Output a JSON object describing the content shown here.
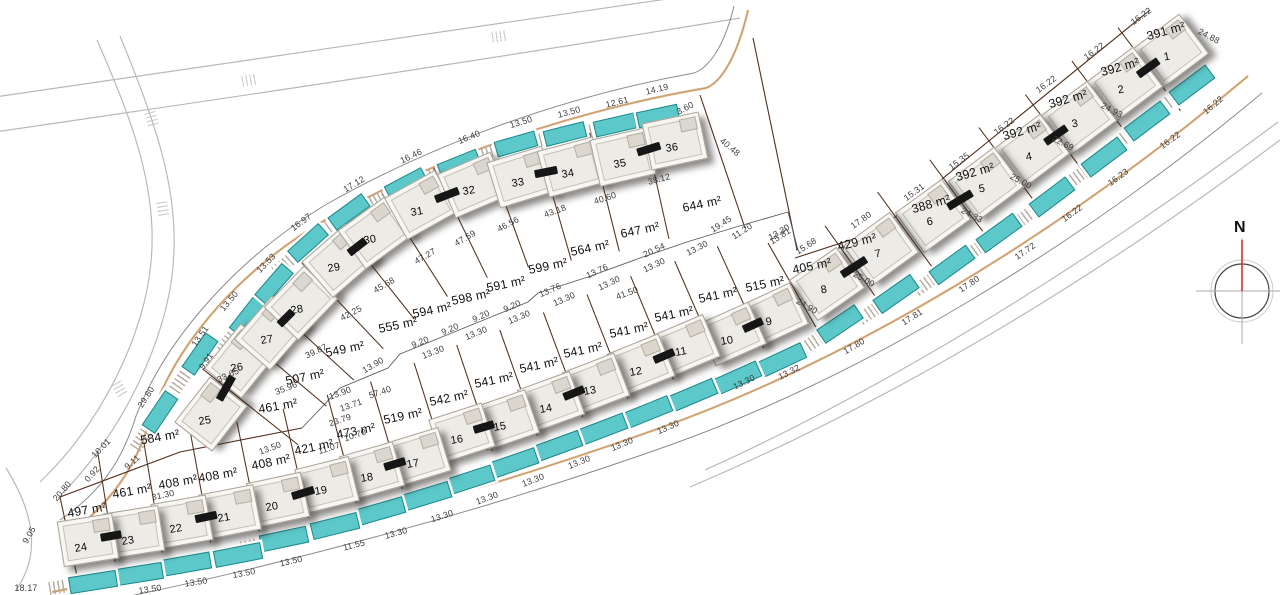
{
  "north": {
    "label": "N"
  },
  "colors": {
    "pool": "#5cc8c9",
    "pool-border": "#20898c",
    "boundary": "#53301d",
    "road-tan": "#d4a16b",
    "curb": "#8c8c8c",
    "faint-road": "#b9b9b9",
    "north-red": "#c43a2a",
    "dim-text": "#3c3c3c"
  },
  "rows": [
    {
      "id": 0,
      "plots": [
        "1",
        "2",
        "3",
        "4",
        "5",
        "6",
        "7",
        "8"
      ],
      "up": 50,
      "dn": 54,
      "house": [
        56,
        48
      ],
      "pool": [
        44,
        15
      ]
    },
    {
      "id": 1,
      "plots": [
        "9",
        "10",
        "11",
        "12",
        "13",
        "14",
        "15",
        "16",
        "17",
        "18",
        "19",
        "20",
        "21",
        "22",
        "23",
        "24"
      ],
      "up": 86,
      "dn": 26,
      "house": [
        54,
        44
      ],
      "pool": [
        46,
        15
      ]
    },
    {
      "id": 2,
      "plots": [
        "25",
        "26",
        "27",
        "28",
        "29",
        "30",
        "31",
        "32",
        "33",
        "34",
        "35",
        "36"
      ],
      "up": 30,
      "dn": 92,
      "house": [
        56,
        46
      ],
      "pool": [
        40,
        14
      ]
    }
  ],
  "plots": [
    {
      "n": "1",
      "a": "391 m²",
      "ax": 1166,
      "ay": 31,
      "ar": -16,
      "hx": 1171,
      "hy": 51,
      "hr": -37,
      "px": 1192,
      "py": 85,
      "pr": -37,
      "nx": 1167,
      "ny": 57,
      "row": 0
    },
    {
      "n": "2",
      "a": "392 m²",
      "ax": 1120,
      "ay": 67,
      "ar": -16,
      "hx": 1125,
      "hy": 84,
      "hr": -37,
      "px": 1147,
      "py": 121,
      "pr": -37,
      "nx": 1121,
      "ny": 90,
      "row": 0
    },
    {
      "n": "3",
      "a": "392 m²",
      "ax": 1068,
      "ay": 99,
      "ar": -16,
      "hx": 1079,
      "hy": 118,
      "hr": -37,
      "px": 1104,
      "py": 157,
      "pr": -37,
      "nx": 1075,
      "ny": 124,
      "row": 0
    },
    {
      "n": "4",
      "a": "392 m²",
      "ax": 1022,
      "ay": 131,
      "ar": -16,
      "hx": 1032,
      "hy": 151,
      "hr": -37,
      "px": 1052,
      "py": 197,
      "pr": -37,
      "nx": 1029,
      "ny": 157,
      "row": 0
    },
    {
      "n": "5",
      "a": "392 m²",
      "ax": 975,
      "ay": 172,
      "ar": -16,
      "hx": 986,
      "hy": 184,
      "hr": -37,
      "px": 999,
      "py": 233,
      "pr": -36,
      "nx": 982,
      "ny": 189,
      "row": 0
    },
    {
      "n": "6",
      "a": "388 m²",
      "ax": 931,
      "ay": 204,
      "ar": -16,
      "hx": 933,
      "hy": 216,
      "hr": -36,
      "px": 952,
      "py": 265,
      "pr": -36,
      "nx": 930,
      "ny": 222,
      "row": 0
    },
    {
      "n": "7",
      "a": "429 m²",
      "ax": 857,
      "ay": 242,
      "ar": -14,
      "hx": 881,
      "hy": 249,
      "hr": -36,
      "px": 896,
      "py": 294,
      "pr": -35,
      "nx": 878,
      "ny": 254,
      "row": 0
    },
    {
      "n": "8",
      "a": "405 m²",
      "ax": 812,
      "ay": 266,
      "ar": -12,
      "hx": 827,
      "hy": 284,
      "hr": -35,
      "px": 840,
      "py": 324,
      "pr": -34,
      "nx": 824,
      "ny": 290,
      "row": 0
    },
    {
      "n": "9",
      "a": "515 m²",
      "ax": 765,
      "ay": 284,
      "ar": -12,
      "hx": 774,
      "hy": 315,
      "hr": -25,
      "px": 782,
      "py": 360,
      "pr": -25,
      "nx": 769,
      "ny": 322,
      "row": 1
    },
    {
      "n": "10",
      "a": "541 m²",
      "ax": 718,
      "ay": 295,
      "ar": -12,
      "hx": 732,
      "hy": 334,
      "hr": -24,
      "px": 737,
      "py": 378,
      "pr": -24,
      "nx": 727,
      "ny": 341,
      "row": 1
    },
    {
      "n": "11",
      "a": "541 m²",
      "ax": 674,
      "ay": 314,
      "ar": -12,
      "hx": 686,
      "hy": 346,
      "hr": -23,
      "px": 693,
      "py": 395,
      "pr": -23,
      "nx": 681,
      "ny": 352,
      "row": 1
    },
    {
      "n": "12",
      "a": "541 m²",
      "ax": 629,
      "ay": 330,
      "ar": -12,
      "hx": 641,
      "hy": 365,
      "hr": -22,
      "px": 648,
      "py": 412,
      "pr": -22,
      "nx": 636,
      "ny": 372,
      "row": 1
    },
    {
      "n": "13",
      "a": "541 m²",
      "ax": 583,
      "ay": 350,
      "ar": -12,
      "hx": 596,
      "hy": 384,
      "hr": -21,
      "px": 603,
      "py": 429,
      "pr": -21,
      "nx": 590,
      "ny": 391,
      "row": 1
    },
    {
      "n": "14",
      "a": "541 m²",
      "ax": 539,
      "ay": 365,
      "ar": -12,
      "hx": 551,
      "hy": 402,
      "hr": -20,
      "px": 558,
      "py": 446,
      "pr": -20,
      "nx": 546,
      "ny": 409,
      "row": 1
    },
    {
      "n": "15",
      "a": "541 m²",
      "ax": 494,
      "ay": 380,
      "ar": -12,
      "hx": 506,
      "hy": 420,
      "hr": -19,
      "px": 514,
      "py": 463,
      "pr": -19,
      "nx": 500,
      "ny": 427,
      "row": 1
    },
    {
      "n": "16",
      "a": "542 m²",
      "ax": 449,
      "ay": 398,
      "ar": -12,
      "hx": 462,
      "hy": 433,
      "hr": -18,
      "px": 470,
      "py": 480,
      "pr": -18,
      "nx": 457,
      "ny": 440,
      "row": 1
    },
    {
      "n": "17",
      "a": "519 m²",
      "ax": 403,
      "ay": 416,
      "ar": -12,
      "hx": 418,
      "hy": 457,
      "hr": -17,
      "px": 427,
      "py": 496,
      "pr": -17,
      "nx": 413,
      "ny": 464,
      "row": 1
    },
    {
      "n": "18",
      "a": "473 m²",
      "ax": 356,
      "ay": 431,
      "ar": -12,
      "hx": 372,
      "hy": 471,
      "hr": -16,
      "px": 381,
      "py": 511,
      "pr": -16,
      "nx": 367,
      "ny": 478,
      "row": 1
    },
    {
      "n": "19",
      "a": "421 m²",
      "ax": 314,
      "ay": 447,
      "ar": -12,
      "hx": 327,
      "hy": 485,
      "hr": -14,
      "px": 335,
      "py": 526,
      "pr": -14,
      "nx": 321,
      "ny": 491,
      "row": 1
    },
    {
      "n": "20",
      "a": "408 m²",
      "ax": 271,
      "ay": 462,
      "ar": -12,
      "hx": 278,
      "hy": 500,
      "hr": -12,
      "px": 284,
      "py": 539,
      "pr": -12,
      "nx": 272,
      "ny": 507,
      "row": 1
    },
    {
      "n": "21",
      "a": "408 m²",
      "ax": 218,
      "ay": 475,
      "ar": -10,
      "hx": 230,
      "hy": 512,
      "hr": -11,
      "px": 238,
      "py": 555,
      "pr": -11,
      "nx": 224,
      "ny": 518,
      "row": 1
    },
    {
      "n": "22",
      "a": "408 m²",
      "ax": 178,
      "ay": 482,
      "ar": -10,
      "hx": 182,
      "hy": 522,
      "hr": -10,
      "px": 187,
      "py": 564,
      "pr": -10,
      "nx": 176,
      "ny": 529,
      "row": 1
    },
    {
      "n": "23",
      "a": "461 m²",
      "ax": 132,
      "ay": 491,
      "ar": -10,
      "hx": 134,
      "hy": 532,
      "hr": -9,
      "px": 139,
      "py": 574,
      "pr": -9,
      "nx": 128,
      "ny": 541,
      "row": 1
    },
    {
      "n": "24",
      "a": "497 m²",
      "ax": 87,
      "ay": 510,
      "ar": -10,
      "hx": 88,
      "hy": 540,
      "hr": -9,
      "px": 93,
      "py": 582,
      "pr": -9,
      "nx": 81,
      "ny": 548,
      "row": 1
    },
    {
      "n": "25",
      "a": "584 m²",
      "ax": 160,
      "ay": 437,
      "ar": -10,
      "hx": 211,
      "hy": 414,
      "hr": -52,
      "px": 160,
      "py": 412,
      "pr": -56,
      "nx": 205,
      "ny": 421,
      "row": 2
    },
    {
      "n": "26",
      "a": "461 m²",
      "ax": 278,
      "ay": 406,
      "ar": -10,
      "hx": 241,
      "hy": 361,
      "hr": -51,
      "px": 200,
      "py": 354,
      "pr": -55,
      "nx": 237,
      "ny": 368,
      "row": 2
    },
    {
      "n": "27",
      "a": "507 m²",
      "ax": 305,
      "ay": 377,
      "ar": -12,
      "hx": 271,
      "hy": 333,
      "hr": -49,
      "px": 248,
      "py": 316,
      "pr": -52,
      "nx": 267,
      "ny": 340,
      "row": 2
    },
    {
      "n": "28",
      "a": "549 m²",
      "ax": 345,
      "ay": 349,
      "ar": -12,
      "hx": 301,
      "hy": 303,
      "hr": -46,
      "px": 274,
      "py": 284,
      "pr": -49,
      "nx": 297,
      "ny": 310,
      "row": 2
    },
    {
      "n": "29",
      "a": "555 m²",
      "ax": 398,
      "ay": 325,
      "ar": -12,
      "hx": 339,
      "hy": 261,
      "hr": -41,
      "px": 308,
      "py": 243,
      "pr": -42,
      "nx": 334,
      "ny": 268,
      "row": 2
    },
    {
      "n": "30",
      "a": "594 m²",
      "ax": 432,
      "ay": 310,
      "ar": -12,
      "hx": 375,
      "hy": 233,
      "hr": -36,
      "px": 349,
      "py": 212,
      "pr": -36,
      "nx": 370,
      "ny": 240,
      "row": 2
    },
    {
      "n": "31",
      "a": "598 m²",
      "ax": 471,
      "ay": 297,
      "ar": -12,
      "hx": 421,
      "hy": 205,
      "hr": -29,
      "px": 406,
      "py": 184,
      "pr": -28,
      "nx": 417,
      "ny": 212,
      "row": 2
    },
    {
      "n": "32",
      "a": "591 m²",
      "ax": 506,
      "ay": 284,
      "ar": -12,
      "hx": 473,
      "hy": 185,
      "hr": -23,
      "px": 459,
      "py": 164,
      "pr": -22,
      "nx": 469,
      "ny": 191,
      "row": 2
    },
    {
      "n": "33",
      "a": "599 m²",
      "ax": 548,
      "ay": 266,
      "ar": -12,
      "hx": 521,
      "hy": 177,
      "hr": -17,
      "px": 516,
      "py": 144,
      "pr": -16,
      "nx": 518,
      "ny": 183,
      "row": 2
    },
    {
      "n": "34",
      "a": "564 m²",
      "ax": 590,
      "ay": 248,
      "ar": -12,
      "hx": 571,
      "hy": 167,
      "hr": -15,
      "px": 565,
      "py": 134,
      "pr": -14,
      "nx": 568,
      "ny": 174,
      "row": 2
    },
    {
      "n": "35",
      "a": "647 m²",
      "ax": 640,
      "ay": 230,
      "ar": -12,
      "hx": 623,
      "hy": 157,
      "hr": -13,
      "px": 615,
      "py": 125,
      "pr": -13,
      "nx": 620,
      "ny": 164,
      "row": 2
    },
    {
      "n": "36",
      "a": "644 m²",
      "ax": 702,
      "ay": 204,
      "ar": -12,
      "hx": 675,
      "hy": 141,
      "hr": -12,
      "px": 658,
      "py": 116,
      "pr": -12,
      "nx": 672,
      "ny": 148,
      "row": 2
    }
  ],
  "dims": [
    [
      "16.22",
      1141,
      16,
      -36
    ],
    [
      "16.22",
      1094,
      51,
      -36
    ],
    [
      "16.22",
      1046,
      84,
      -36
    ],
    [
      "16.22",
      1004,
      126,
      -36
    ],
    [
      "15.35",
      959,
      161,
      -36
    ],
    [
      "15.31",
      914,
      192,
      -36
    ],
    [
      "17.80",
      861,
      220,
      -35
    ],
    [
      "15.68",
      806,
      246,
      -33
    ],
    [
      "15.81",
      780,
      236,
      -33
    ],
    [
      "11.20",
      742,
      231,
      -33
    ],
    [
      "19.45",
      721,
      224,
      -33
    ],
    [
      "24.88",
      1209,
      36,
      28
    ],
    [
      "24.93",
      1112,
      110,
      28
    ],
    [
      "22.69",
      1063,
      143,
      28
    ],
    [
      "25.00",
      1021,
      181,
      28
    ],
    [
      "24.33",
      972,
      215,
      28
    ],
    [
      "25.00",
      864,
      279,
      30
    ],
    [
      "24.90",
      807,
      306,
      30
    ],
    [
      "40.48",
      730,
      147,
      40
    ],
    [
      "3.60",
      685,
      108,
      -28
    ],
    [
      "14.19",
      657,
      89,
      -14
    ],
    [
      "12.61",
      617,
      102,
      -14
    ],
    [
      "13.50",
      569,
      112,
      -15
    ],
    [
      "13.50",
      521,
      122,
      -17
    ],
    [
      "16.40",
      469,
      137,
      -22
    ],
    [
      "16.46",
      411,
      156,
      -26
    ],
    [
      "17.12",
      354,
      184,
      -31
    ],
    [
      "16.97",
      301,
      222,
      -37
    ],
    [
      "13.53",
      266,
      263,
      -46
    ],
    [
      "13.50",
      229,
      301,
      -50
    ],
    [
      "13.51",
      200,
      336,
      -55
    ],
    [
      "9.91",
      206,
      361,
      -55
    ],
    [
      "29.80",
      146,
      397,
      -57
    ],
    [
      "16.22",
      1213,
      105,
      -40
    ],
    [
      "16.22",
      1170,
      140,
      -36
    ],
    [
      "16.23",
      1118,
      177,
      -36
    ],
    [
      "16.22",
      1072,
      213,
      -36
    ],
    [
      "17.72",
      1025,
      251,
      -35
    ],
    [
      "17.80",
      969,
      284,
      -34
    ],
    [
      "17.81",
      912,
      317,
      -32
    ],
    [
      "17.80",
      854,
      346,
      -30
    ],
    [
      "13.32",
      789,
      372,
      -27
    ],
    [
      "13.30",
      744,
      382,
      -26
    ],
    [
      "13.30",
      668,
      427,
      -24
    ],
    [
      "13.30",
      622,
      444,
      -23
    ],
    [
      "13.30",
      579,
      462,
      -22
    ],
    [
      "13.30",
      533,
      480,
      -21
    ],
    [
      "13.30",
      487,
      498,
      -20
    ],
    [
      "13.30",
      442,
      516,
      -18
    ],
    [
      "13.30",
      396,
      533,
      -16
    ],
    [
      "11.55",
      354,
      545,
      -14
    ],
    [
      "13.50",
      291,
      561,
      -13
    ],
    [
      "13.50",
      244,
      573,
      -11
    ],
    [
      "13.50",
      196,
      582,
      -9
    ],
    [
      "13.50",
      150,
      589,
      -8
    ],
    [
      "9.05",
      29,
      535,
      -60
    ],
    [
      "18.17",
      26,
      588,
      0
    ],
    [
      "20.80",
      62,
      491,
      -50
    ],
    [
      "0.92",
      92,
      474,
      -48
    ],
    [
      "9.11",
      132,
      462,
      -42
    ],
    [
      "10.01",
      101,
      448,
      -46
    ],
    [
      "31.30",
      163,
      495,
      -12
    ],
    [
      "20.54",
      654,
      250,
      -25
    ],
    [
      "13.30",
      697,
      248,
      -27
    ],
    [
      "13.30",
      779,
      232,
      -30
    ],
    [
      "13.30",
      654,
      265,
      -25
    ],
    [
      "41.50",
      627,
      293,
      -20
    ],
    [
      "13.76",
      597,
      271,
      -25
    ],
    [
      "13.76",
      550,
      290,
      -24
    ],
    [
      "13.30",
      609,
      283,
      -25
    ],
    [
      "13.30",
      564,
      299,
      -24
    ],
    [
      "13.30",
      519,
      317,
      -23
    ],
    [
      "13.30",
      476,
      333,
      -22
    ],
    [
      "13.30",
      433,
      352,
      -21
    ],
    [
      "9.20",
      512,
      306,
      -24
    ],
    [
      "9.20",
      481,
      316,
      -24
    ],
    [
      "9.20",
      450,
      329,
      -23
    ],
    [
      "9.20",
      420,
      342,
      -22
    ],
    [
      "13.90",
      340,
      393,
      -20
    ],
    [
      "57.40",
      380,
      392,
      -18
    ],
    [
      "13.71",
      351,
      405,
      -19
    ],
    [
      "23.79",
      340,
      420,
      -19
    ],
    [
      "10.70",
      355,
      435,
      -19
    ],
    [
      "11.07",
      329,
      448,
      -18
    ],
    [
      "13.50",
      270,
      448,
      -20
    ],
    [
      "13.90",
      373,
      365,
      -30
    ],
    [
      "33.65",
      228,
      375,
      -25
    ],
    [
      "35.96",
      286,
      388,
      -22
    ],
    [
      "39.87",
      316,
      351,
      -25
    ],
    [
      "42.25",
      351,
      313,
      -28
    ],
    [
      "45.68",
      384,
      285,
      -30
    ],
    [
      "47.27",
      425,
      256,
      -30
    ],
    [
      "47.59",
      465,
      238,
      -30
    ],
    [
      "46.56",
      508,
      224,
      -28
    ],
    [
      "43.18",
      555,
      211,
      -20
    ],
    [
      "40.60",
      605,
      198,
      -18
    ],
    [
      "38.12",
      659,
      179,
      -15
    ]
  ],
  "hatches": [
    [
      152,
      120,
      75
    ],
    [
      163,
      210,
      80
    ],
    [
      120,
      390,
      60
    ],
    [
      250,
      80,
      -10
    ],
    [
      500,
      36,
      -8
    ]
  ]
}
